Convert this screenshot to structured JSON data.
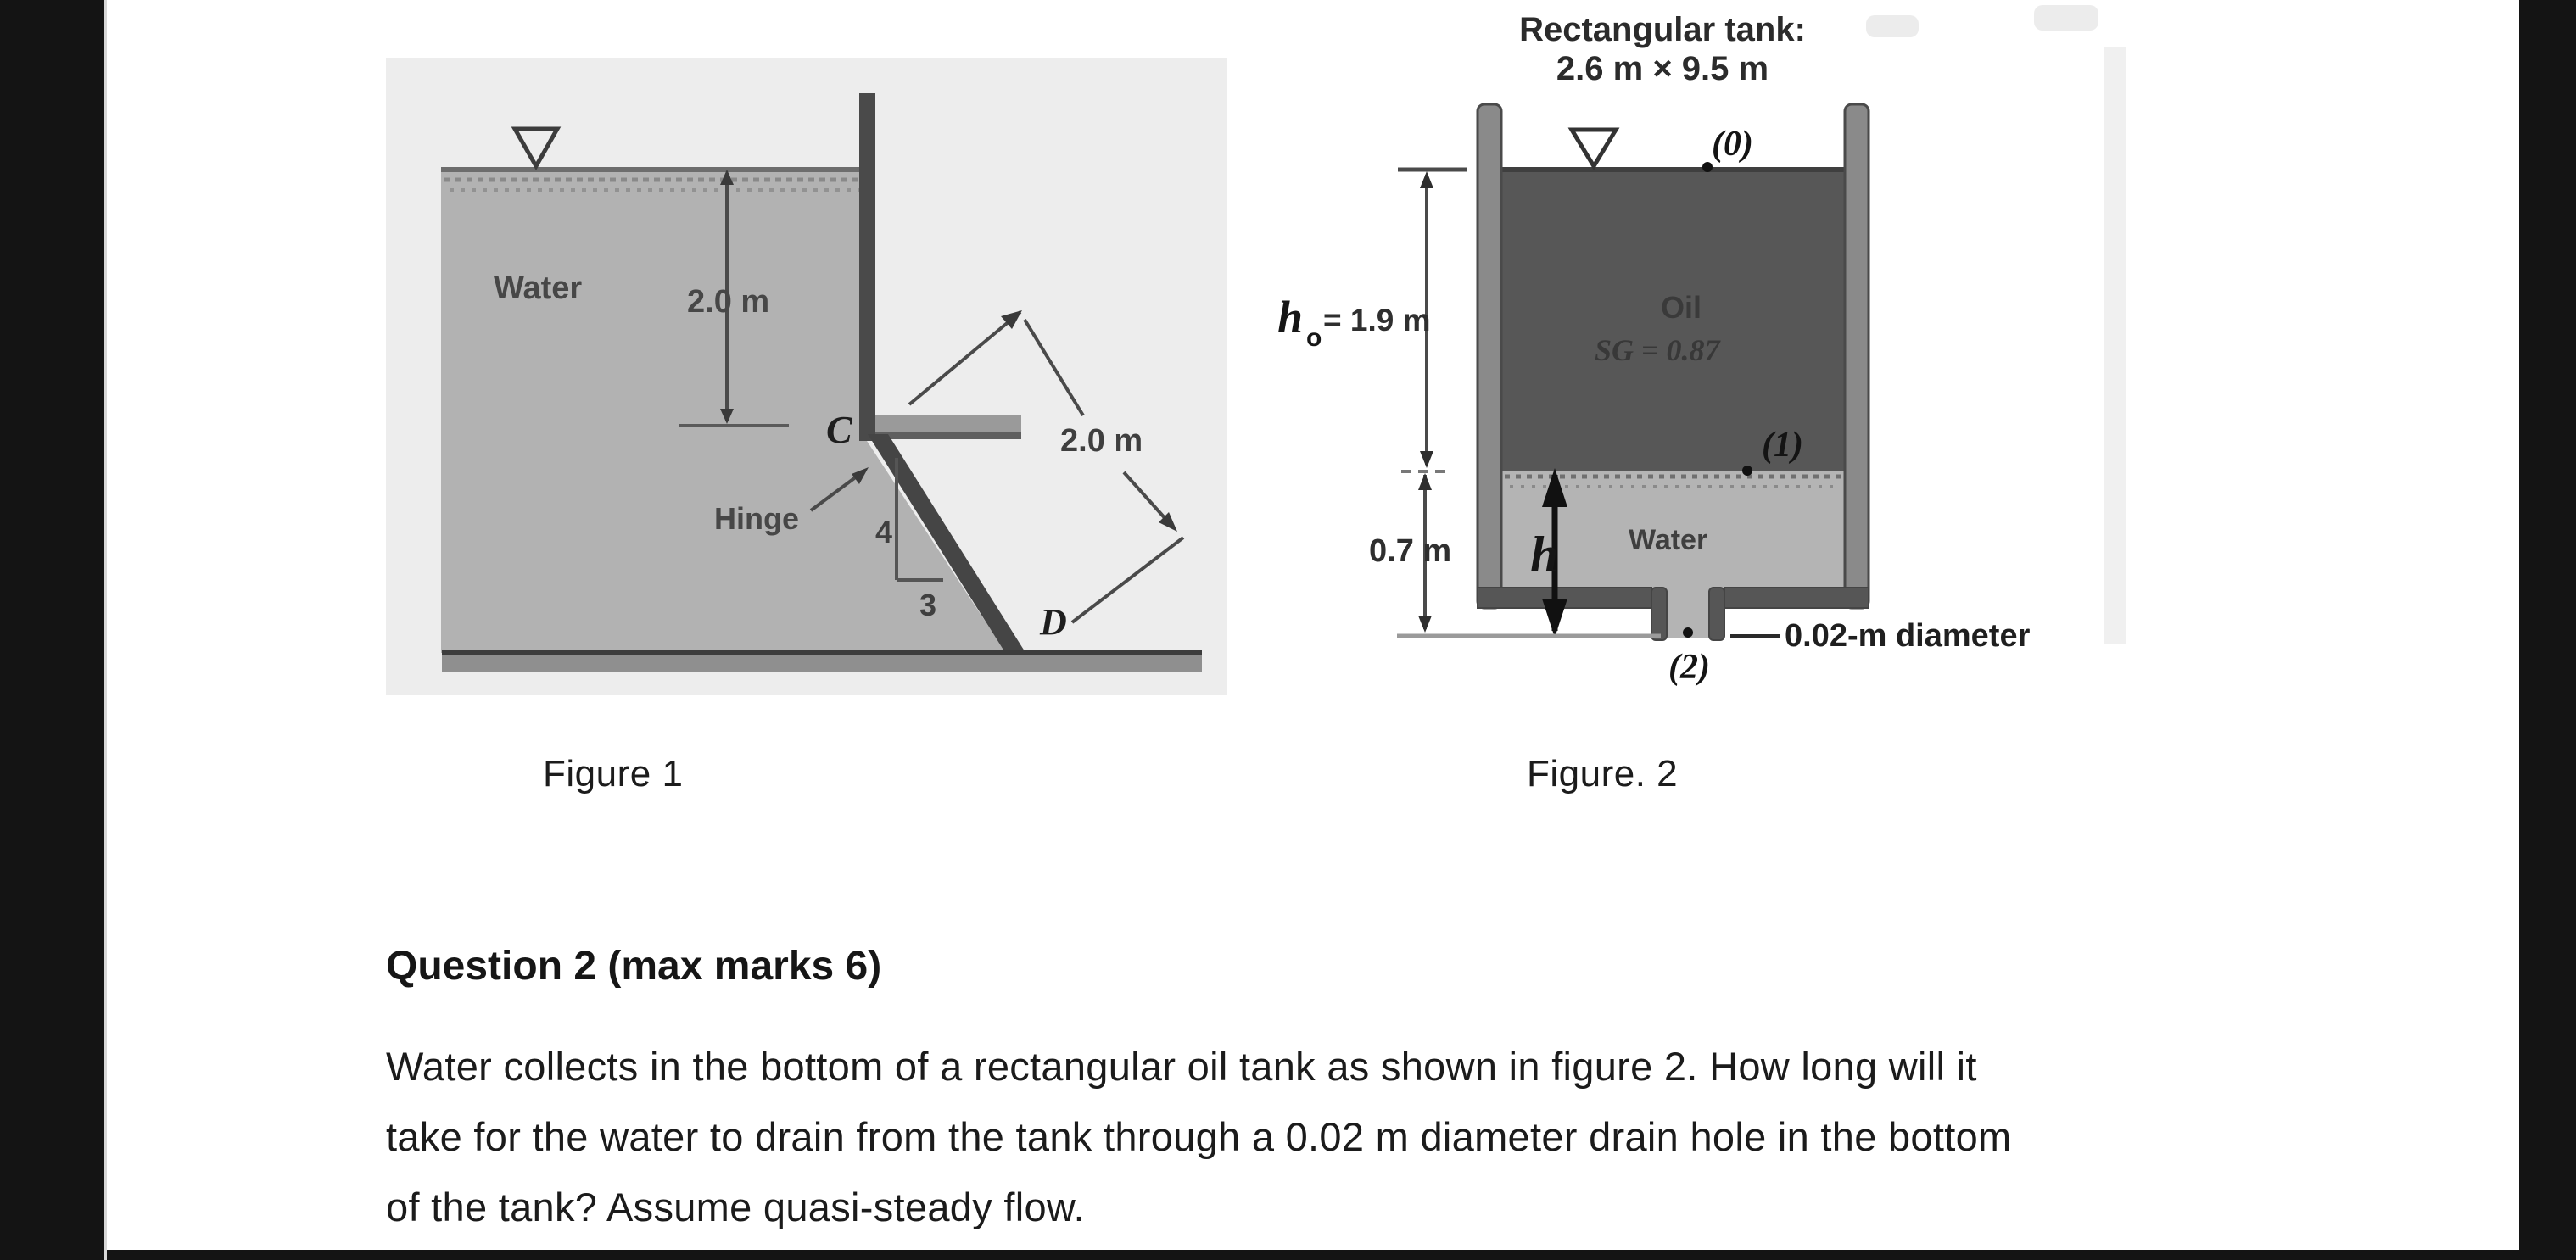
{
  "page": {
    "background": "#ffffff",
    "frame_color": "#141414"
  },
  "figure1": {
    "caption": "Figure 1",
    "labels": {
      "water": "Water",
      "depth": "2.0 m",
      "point_c": "C",
      "hinge": "Hinge",
      "slope_rise": "4",
      "slope_run": "3",
      "point_d": "D",
      "gate_length": "2.0 m"
    },
    "colors": {
      "scan_background": "#ededed",
      "water_fill": "#b2b2b2",
      "structure": "#4a4a4a"
    }
  },
  "figure2": {
    "caption": "Figure. 2",
    "title_line1": "Rectangular tank:",
    "title_line2": "2.6 m × 9.5 m",
    "labels": {
      "station_top": "(0)",
      "station_interface": "(1)",
      "station_drain": "(2)",
      "oil": "Oil",
      "oil_sg": "SG = 0.87",
      "water": "Water",
      "oil_height_symbol": "h",
      "oil_height_sub": "o",
      "oil_height_value": "= 1.9 m",
      "water_height": "0.7 m",
      "varying_height": "h",
      "drain_note": "0.02-m diameter"
    },
    "colors": {
      "oil_fill": "#575757",
      "water_fill": "#b4b4b4",
      "wall_fill": "#8a8a8a"
    }
  },
  "question": {
    "heading": "Question 2 (max marks 6)",
    "body_lines": [
      "Water collects in the bottom of a rectangular oil tank as shown in figure 2. How long will it",
      "take for the water to drain from the tank through a 0.02 m diameter drain hole in the bottom",
      "of the tank? Assume quasi-steady flow."
    ]
  }
}
